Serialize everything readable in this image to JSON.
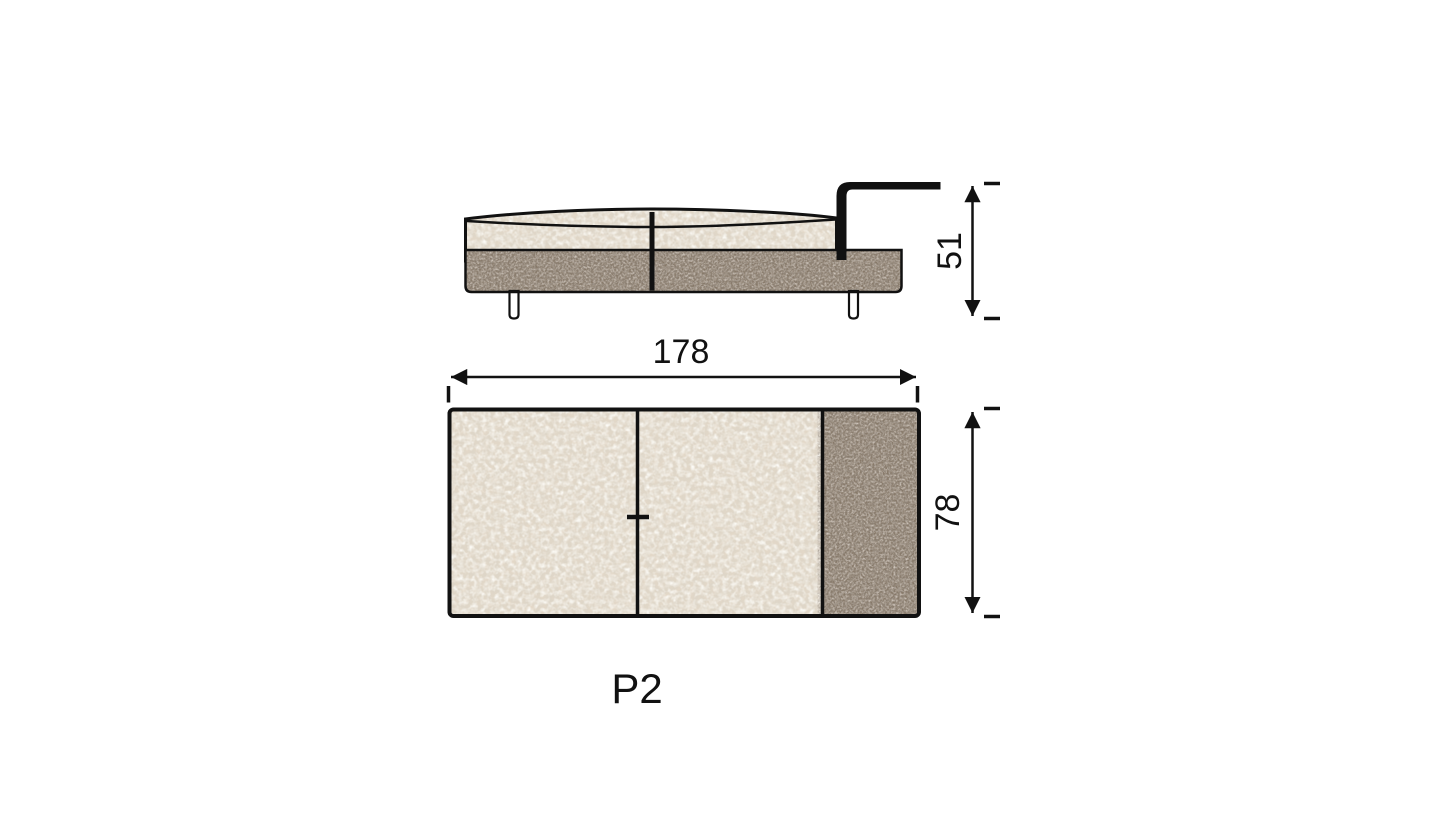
{
  "diagram": {
    "product_label": "P2",
    "side_view": {
      "height_label": "51"
    },
    "top_view": {
      "width_label": "178",
      "depth_label": "78"
    },
    "dimensions": {
      "width": 178,
      "depth": 78,
      "height": 51
    },
    "colors": {
      "background": "#ffffff",
      "outline": "#111111",
      "fabric": "#ded6c8",
      "leather": "#867868",
      "leg": "#ffffff"
    },
    "textures": {
      "seat": "boucle-fabric-texture",
      "base": "leather-grain-texture",
      "frame": "black-metal-tube"
    }
  }
}
